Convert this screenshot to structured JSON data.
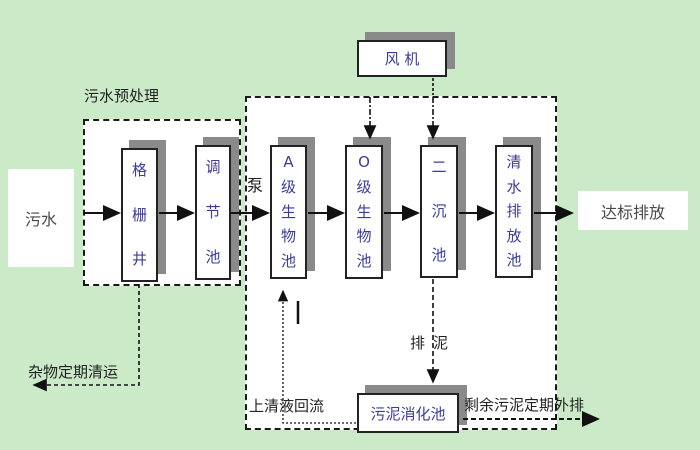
{
  "diagram": {
    "nodes": {
      "influent": "污水",
      "fan": "风 机",
      "grid_well": "格栅井",
      "regulating_tank": "调节池",
      "a_bio_tank": "A级生物池",
      "o_bio_tank": "O级生物池",
      "secondary_tank": "二沉池",
      "clear_water_tank": "清水排放池",
      "sludge_digestion_tank": "污泥消化池",
      "discharge": "达标排放"
    },
    "labels": {
      "preprocess": "污水预处理",
      "pump": "泵",
      "waste_removal": "杂物定期清运",
      "supernatant_return": "上清液回流",
      "sludge_discharge": "排泥",
      "excess_sludge_out": "剩余污泥定期外排"
    },
    "colors": {
      "background": "#cbeac8",
      "box_fill": "#ffffff",
      "box_border": "#222222",
      "box_text": "#3b3b9e",
      "shadow": "#8a8a8a",
      "label_text": "#222222",
      "line": "#111111"
    }
  }
}
